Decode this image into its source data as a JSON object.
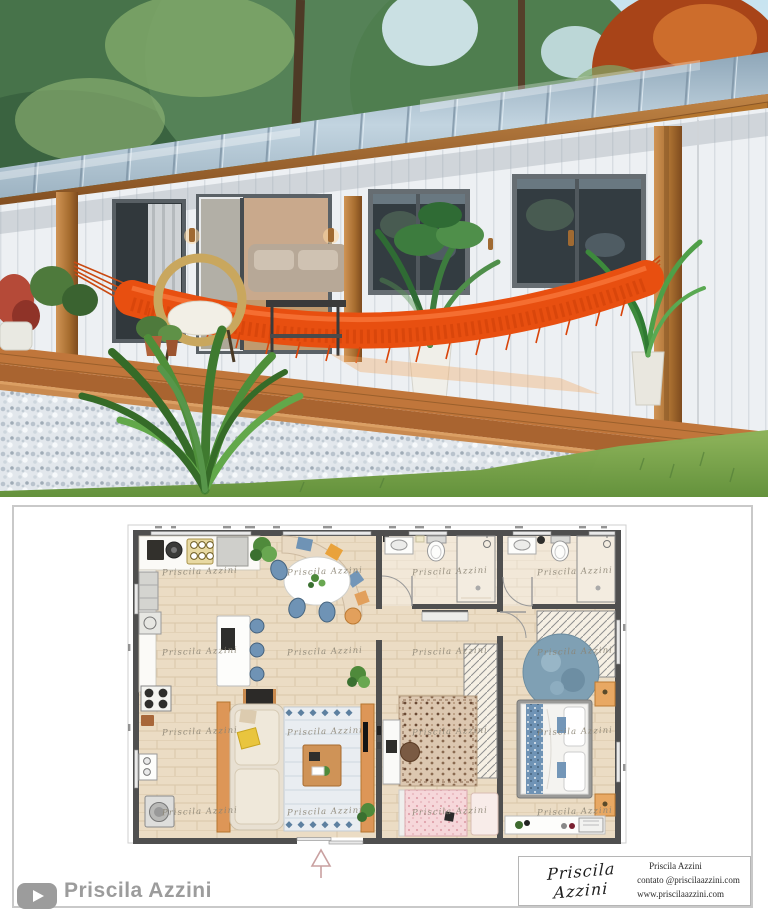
{
  "floorplan": {
    "watermark": "Priscila Azzini"
  },
  "footer": {
    "channel_name": "Priscila Azzini"
  },
  "contact_card": {
    "signature": "Priscila Azzini",
    "line1": "Priscila Azzini",
    "line2": "contato @priscilaazzini.com",
    "line3": "www.priscilaazzini.com"
  },
  "colors": {
    "hammock": "#e84f10",
    "roof_metal": "#a9bfce",
    "deck_wood": "#b9713a",
    "plan_floor": "#ebdcc4",
    "watermark_gray": "#8b8474",
    "footer_gray": "#9c9c9c"
  }
}
